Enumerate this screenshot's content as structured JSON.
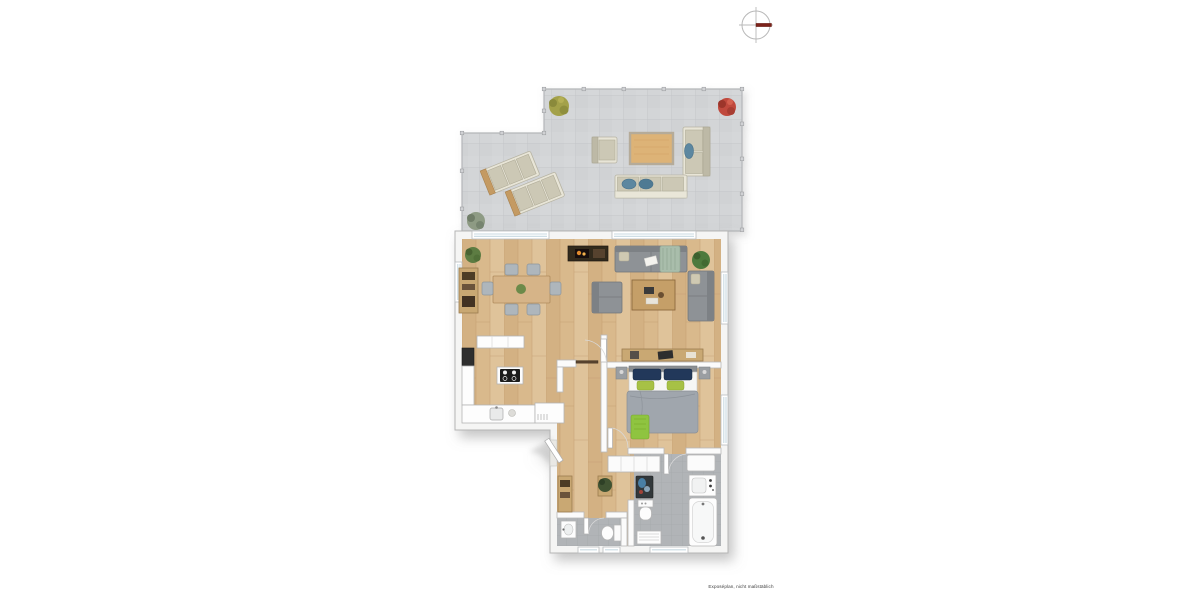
{
  "caption": {
    "text": "Exposéplan, nicht maßstäblich"
  },
  "compass": {
    "direction": "east",
    "needle_color": "#7c221a",
    "ring_color": "#b8b8b8"
  },
  "palette": {
    "background": "#ffffff",
    "wood_floor": "#d9b98c",
    "terrace_tile": "#d3d5d7",
    "bath_tile": "#b1b4b7",
    "wall": "#fbfbfb",
    "sofa_gray": "#8e9296",
    "outdoor_beige": "#ccc8b5",
    "pillow_blue": "#5b87a0",
    "bed_pillow_navy": "#24395a",
    "accent_green": "#8fc43f",
    "blanket_gray": "#a0a6ad",
    "furniture_wood": "#c9a873",
    "flame_orange": "#e08a2e",
    "plant_green": "#4e7a3d",
    "plant_red": "#c0493c",
    "plant_olive": "#a3a148"
  },
  "areas": [
    {
      "id": "terrace",
      "floor": "tile"
    },
    {
      "id": "living-room",
      "floor": "wood"
    },
    {
      "id": "dining-area",
      "floor": "wood"
    },
    {
      "id": "kitchen",
      "floor": "wood"
    },
    {
      "id": "hallway",
      "floor": "wood"
    },
    {
      "id": "bedroom",
      "floor": "wood"
    },
    {
      "id": "bathroom",
      "floor": "tile"
    },
    {
      "id": "wc",
      "floor": "tile"
    }
  ],
  "furniture_inventory": {
    "terrace": [
      "sun-lounger",
      "sun-lounger",
      "outdoor-armchair",
      "outdoor-coffee-table",
      "outdoor-sofa",
      "outdoor-sofa",
      "shrub-olive",
      "shrub-red",
      "shrub-gray"
    ],
    "dining-area": [
      "dining-table",
      "dining-chair x6",
      "sideboard",
      "plant"
    ],
    "living-room": [
      "fireplace-media-unit",
      "sofa",
      "sofa",
      "armchair",
      "coffee-table",
      "plant"
    ],
    "kitchen": [
      "counter-row",
      "tall-cabinet",
      "sink-counter",
      "cooktop-island",
      "peninsula-shelf"
    ],
    "hallway": [
      "wardrobe-closet",
      "console-plant",
      "sideboard"
    ],
    "bedroom": [
      "double-bed",
      "nightstand",
      "nightstand",
      "sideboard"
    ],
    "bathroom": [
      "washing-machine",
      "toilet",
      "towel-radiator",
      "vanity-cabinet",
      "washbasin-counter",
      "bathtub"
    ],
    "wc": [
      "washbasin",
      "toilet"
    ]
  }
}
